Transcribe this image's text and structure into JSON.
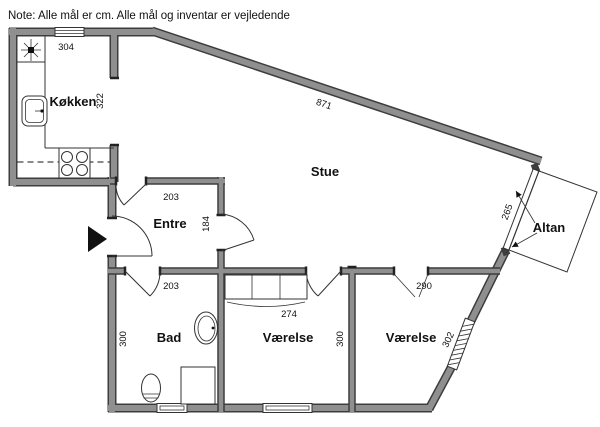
{
  "note": "Note: Alle mål er cm. Alle mål og inventar er vejledende",
  "rooms": {
    "kitchen": "Køkken",
    "living": "Stue",
    "hall": "Entre",
    "bath": "Bad",
    "bedroom1": "Værelse",
    "bedroom2": "Værelse",
    "balcony": "Altan"
  },
  "dimensions": {
    "top_wall": "304",
    "kitchen_depth": "322",
    "north_wall": "871",
    "hall_width": "203",
    "hall_depth": "184",
    "bath_width": "203",
    "bath_depth": "300",
    "wardrobe_width": "274",
    "bedroom1_depth": "300",
    "bedroom2_opening": "290",
    "bedroom2_wall": "302",
    "balcony_door": "265"
  },
  "colors": {
    "wall_fill": "#8f8f8f",
    "wall_edge": "#3d3d3d",
    "line": "#333333",
    "text": "#111111",
    "background": "#ffffff"
  }
}
